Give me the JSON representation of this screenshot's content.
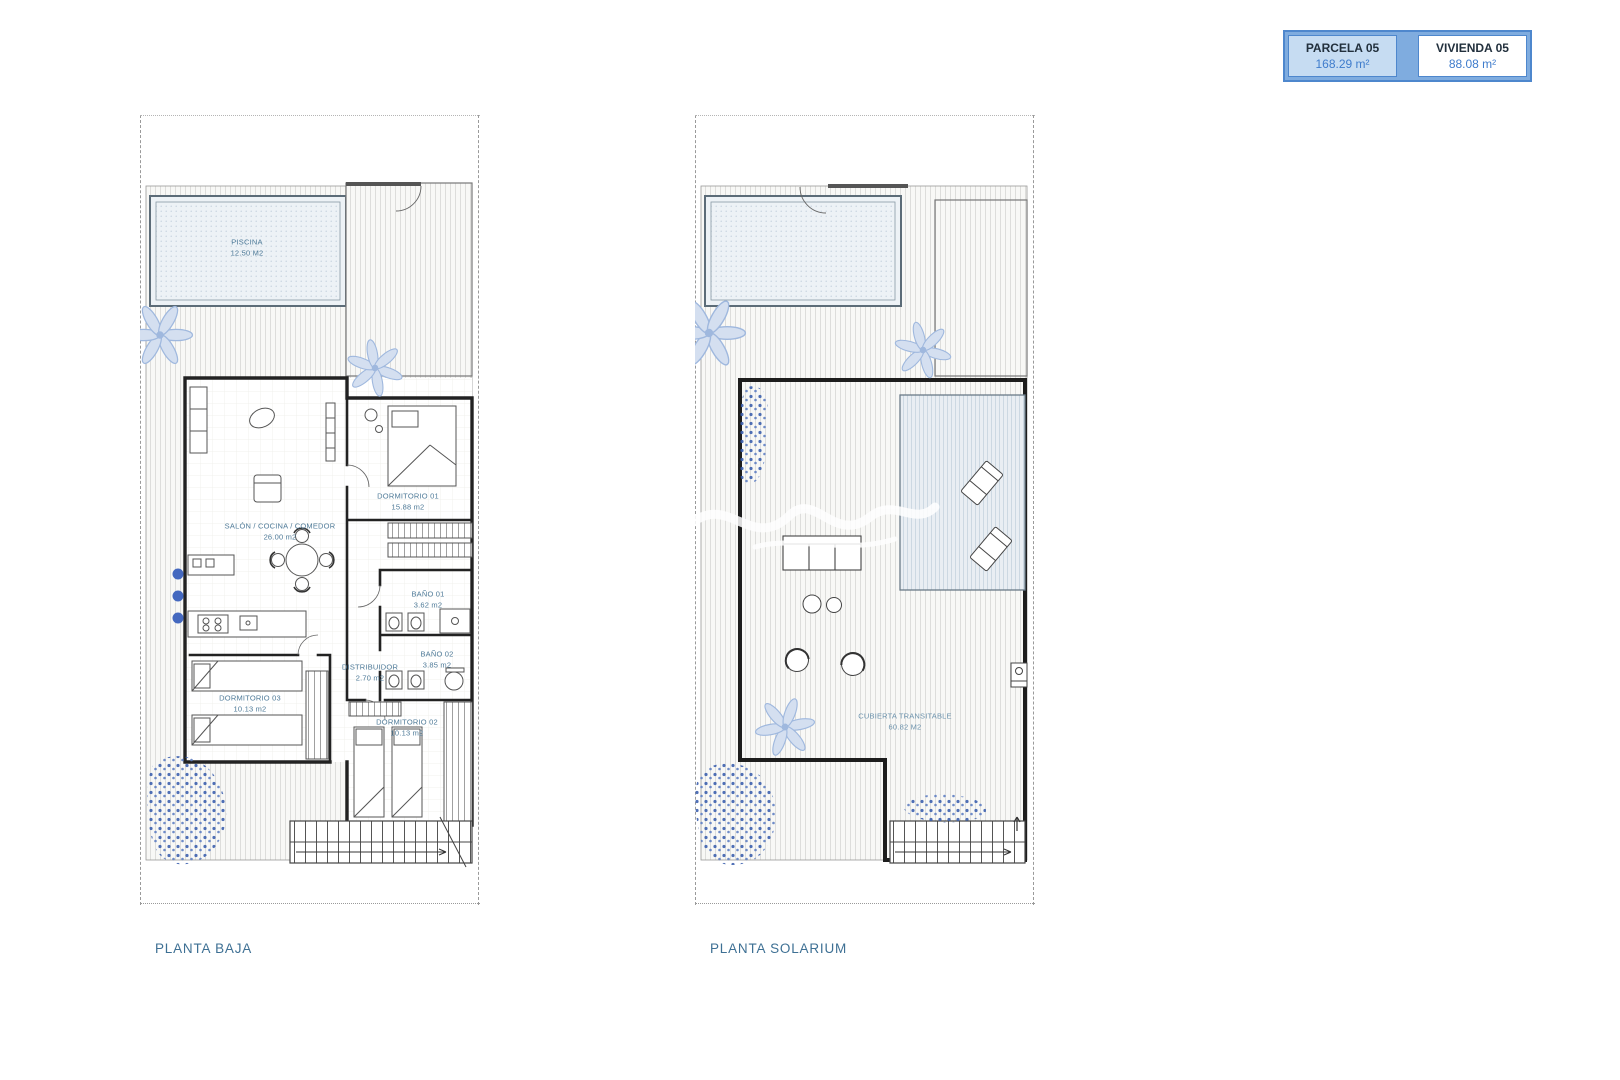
{
  "header": {
    "parcela_label": "PARCELA 05",
    "parcela_area": "168.29 m²",
    "vivienda_label": "VIVIENDA 05",
    "vivienda_area": "88.08 m²"
  },
  "planta_baja": {
    "title": "PLANTA BAJA",
    "rooms": {
      "piscina": {
        "name": "PISCINA",
        "area": "12.50 M2"
      },
      "salon": {
        "name": "SALÓN / COCINA / COMEDOR",
        "area": "26.00 m2"
      },
      "dormitorio1": {
        "name": "DORMITORIO 01",
        "area": "15.88 m2"
      },
      "bano1": {
        "name": "BAÑO 01",
        "area": "3.62 m2"
      },
      "distribuidor": {
        "name": "DISTRIBUIDOR",
        "area": "2.70 m2"
      },
      "bano2": {
        "name": "BAÑO 02",
        "area": "3.85 m2"
      },
      "dormitorio3": {
        "name": "DORMITORIO 03",
        "area": "10.13 m2"
      },
      "dormitorio2": {
        "name": "DORMITORIO 02",
        "area": "10.13 m2"
      }
    }
  },
  "planta_solarium": {
    "title": "PLANTA SOLARIUM",
    "rooms": {
      "cubierta": {
        "name": "CUBIERTA TRANSITABLE",
        "area": "60.82 M2"
      }
    }
  },
  "colors": {
    "box_border": "#4e87cd",
    "box_fill": "#7facdf",
    "parcela_cell_bg": "#c6dcf2",
    "area_value_text": "#3f7ccc",
    "room_label_text": "#4e7a98",
    "title_text": "#3e7094",
    "plant_light_blue": "#9fb8de",
    "shrub_dark_blue": "#3c60ae"
  }
}
